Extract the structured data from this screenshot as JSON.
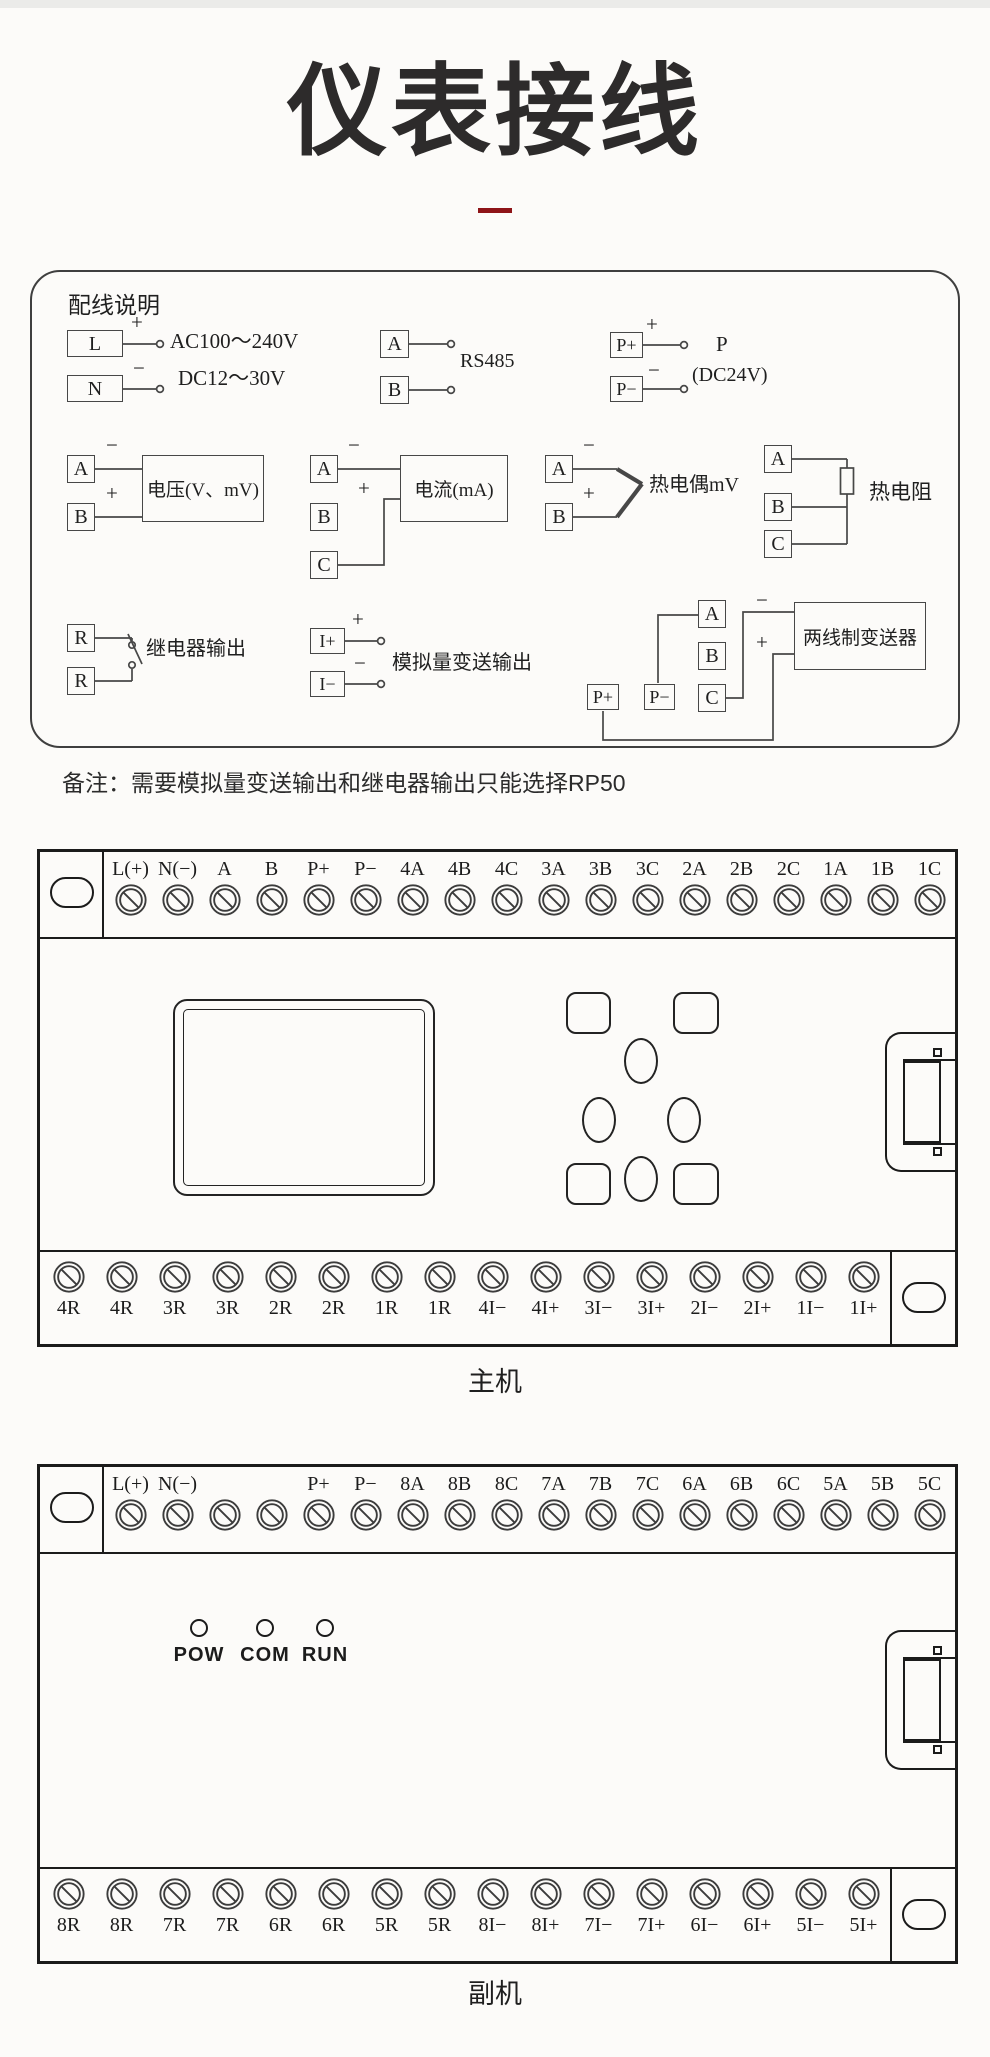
{
  "page": {
    "title": "仪表接线"
  },
  "colors": {
    "accent": "#8e1418"
  },
  "wiring_box": {
    "title": "配线说明",
    "power": {
      "l": "L",
      "n": "N",
      "plus": "+",
      "minus": "−",
      "volt1": "AC100～240V",
      "volt2": "DC12～30V"
    },
    "rs485": {
      "a": "A",
      "b": "B",
      "label": "RS485"
    },
    "power_out": {
      "pp": "P+",
      "pm": "P−",
      "plus": "+",
      "minus": "−",
      "name": "P",
      "volt": "(DC24V)"
    },
    "voltage": {
      "a": "A",
      "b": "B",
      "minus": "−",
      "plus": "+",
      "label": "电压(V、mV)"
    },
    "current": {
      "a": "A",
      "b": "B",
      "c": "C",
      "minus": "−",
      "plus": "+",
      "label": "电流(mA)"
    },
    "thermocouple": {
      "a": "A",
      "b": "B",
      "minus": "−",
      "plus": "+",
      "label": "热电偶mV"
    },
    "rtd": {
      "a": "A",
      "b": "B",
      "c": "C",
      "label": "热电阻"
    },
    "relay": {
      "r1": "R",
      "r2": "R",
      "label": "继电器输出"
    },
    "analog_out": {
      "ip": "I+",
      "im": "I−",
      "plus": "+",
      "minus": "−",
      "label": "模拟量变送输出"
    },
    "transmitter": {
      "pp": "P+",
      "pm": "P−",
      "a": "A",
      "b": "B",
      "c": "C",
      "plus": "+",
      "minus": "−",
      "label": "两线制变送器"
    }
  },
  "note": "备注：需要模拟量变送输出和继电器输出只能选择RP50",
  "main_unit": {
    "caption": "主机",
    "top_terminals": [
      "L(+)",
      "N(−)",
      "A",
      "B",
      "P+",
      "P−",
      "4A",
      "4B",
      "4C",
      "3A",
      "3B",
      "3C",
      "2A",
      "2B",
      "2C",
      "1A",
      "1B",
      "1C"
    ],
    "bottom_terminals": [
      "4R",
      "4R",
      "3R",
      "3R",
      "2R",
      "2R",
      "1R",
      "1R",
      "4I−",
      "4I+",
      "3I−",
      "3I+",
      "2I−",
      "2I+",
      "1I−",
      "1I+"
    ]
  },
  "aux_unit": {
    "caption": "副机",
    "leds": [
      "POW",
      "COM",
      "RUN"
    ],
    "top_terminals": [
      "L(+)",
      "N(−)",
      "",
      "",
      "P+",
      "P−",
      "8A",
      "8B",
      "8C",
      "7A",
      "7B",
      "7C",
      "6A",
      "6B",
      "6C",
      "5A",
      "5B",
      "5C"
    ],
    "bottom_terminals": [
      "8R",
      "8R",
      "7R",
      "7R",
      "6R",
      "6R",
      "5R",
      "5R",
      "8I−",
      "8I+",
      "7I−",
      "7I+",
      "6I−",
      "6I+",
      "5I−",
      "5I+"
    ]
  }
}
